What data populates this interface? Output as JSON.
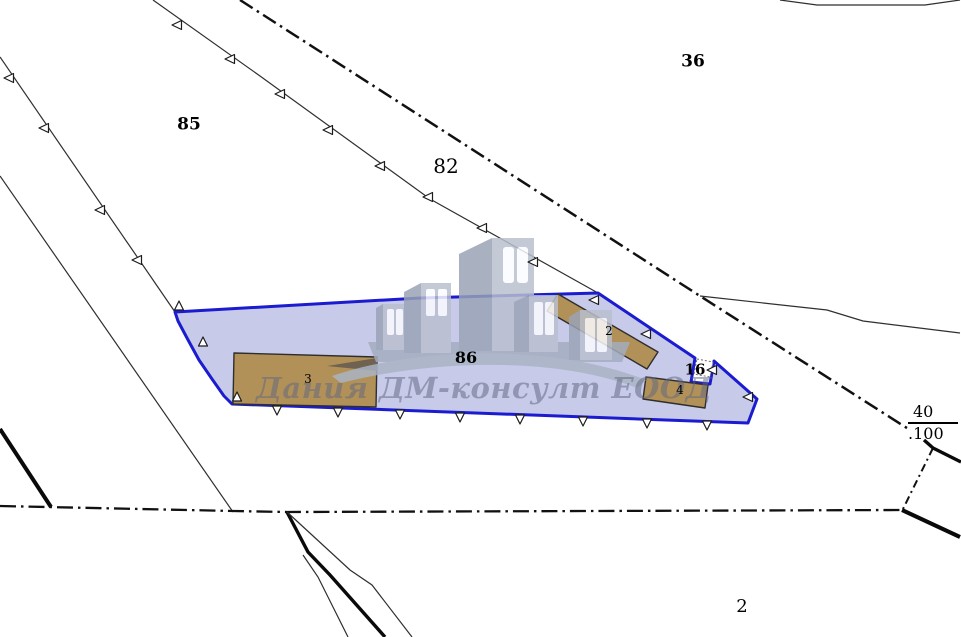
{
  "watermark": {
    "text": "Дания ДМ-консулт ЕООД"
  },
  "labels": {
    "parcel_85": "85",
    "parcel_82": "82",
    "parcel_36": "36",
    "parcel_86": "86",
    "parcel_16": "16",
    "parcel_2": "2",
    "building_2": "2",
    "building_3": "3",
    "building_4": "4",
    "point_number": "40",
    "point_elevation": ".100"
  },
  "colors": {
    "parcel-outline": "#1b1bd0",
    "parcel-fill": "#c7cae8",
    "building-fill": "#b29158",
    "building-stroke": "#2e2e2e",
    "line-color": "#2f2f2f"
  }
}
